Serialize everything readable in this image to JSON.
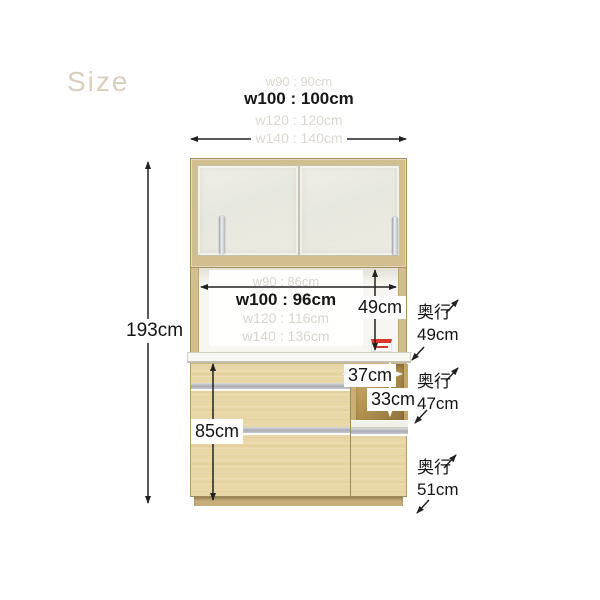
{
  "header": {
    "title": "Size"
  },
  "top_widths": {
    "w90": "w90 : 90cm",
    "w100": "w100 : 100cm",
    "w120": "w120 : 120cm",
    "w140": "w140 : 140cm"
  },
  "inner_widths": {
    "w90": "w90 : 86cm",
    "w100": "w100 : 96cm",
    "w120": "w120 : 116cm",
    "w140": "w140 : 136cm"
  },
  "dimensions": {
    "total_height": "193cm",
    "upper_open_height": "49cm",
    "niche_width": "37cm",
    "niche_height": "33cm",
    "base_height": "85cm"
  },
  "depths": {
    "label": "奥行",
    "upper": "49cm",
    "middle": "47cm",
    "lower": "51cm"
  },
  "colors": {
    "wood_frame": "#d2be8f",
    "wood_front": "#e9d6a6",
    "glass": "#eaeae1",
    "niche_dark": "#9a7c45",
    "counter": "#f7f7f3",
    "handle_silver": "#b5b9bd",
    "arrow": "#222222",
    "title_text": "#d9cfbc",
    "faded_text": "#dcd8d0",
    "outlet_red": "#d8372c"
  }
}
